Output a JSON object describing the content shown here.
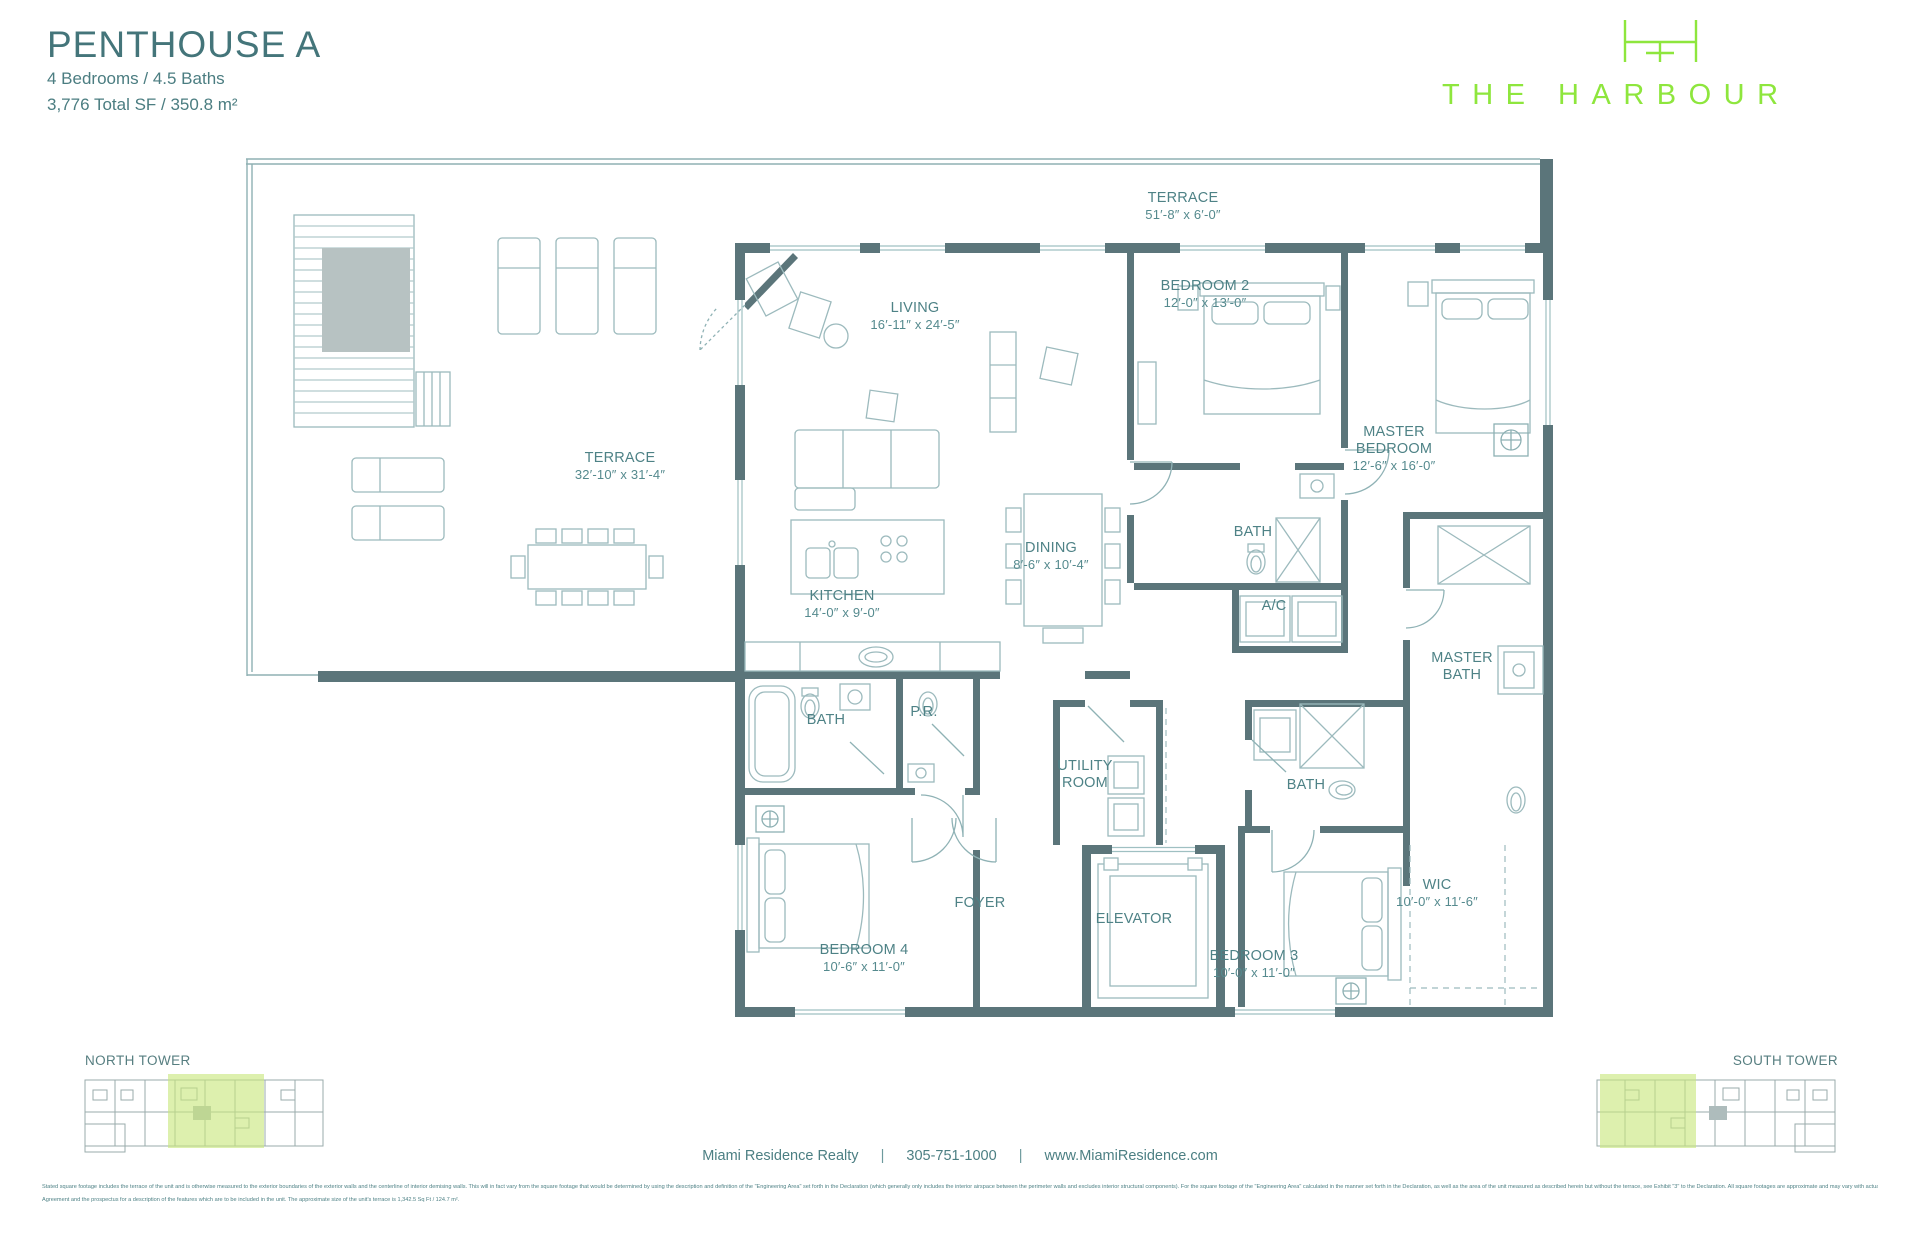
{
  "header": {
    "title": "PENTHOUSE A",
    "specs": "4 Bedrooms / 4.5 Baths",
    "area": "3,776 Total SF / 350.8 m²"
  },
  "brand": {
    "name": "THE HARBOUR"
  },
  "floorplan": {
    "rooms": [
      {
        "id": "terrace-top",
        "label": "TERRACE",
        "dims": "51′-8″ x 6′-0″"
      },
      {
        "id": "living",
        "label": "LIVING",
        "dims": "16′-11″ x 24′-5″"
      },
      {
        "id": "bedroom-2",
        "label": "BEDROOM 2",
        "dims": "12′-0″ x 13′-0″"
      },
      {
        "id": "master-bedroom",
        "label": "MASTER BEDROOM",
        "dims": "12′-6″ x 16′-0″"
      },
      {
        "id": "terrace-left",
        "label": "TERRACE",
        "dims": "32′-10″ x 31′-4″"
      },
      {
        "id": "dining",
        "label": "DINING",
        "dims": "8′-6″ x 10′-4″"
      },
      {
        "id": "kitchen",
        "label": "KITCHEN",
        "dims": "14′-0″ x 9′-0″"
      },
      {
        "id": "bath-2",
        "label": "BATH",
        "dims": ""
      },
      {
        "id": "ac",
        "label": "A/C",
        "dims": ""
      },
      {
        "id": "master-bath",
        "label": "MASTER BATH",
        "dims": ""
      },
      {
        "id": "bath-4",
        "label": "BATH",
        "dims": ""
      },
      {
        "id": "powder-room",
        "label": "P.R.",
        "dims": ""
      },
      {
        "id": "utility-room",
        "label": "UTILITY ROOM",
        "dims": ""
      },
      {
        "id": "bath-3",
        "label": "BATH",
        "dims": ""
      },
      {
        "id": "foyer",
        "label": "FOYER",
        "dims": ""
      },
      {
        "id": "elevator",
        "label": "ELEVATOR",
        "dims": ""
      },
      {
        "id": "wic",
        "label": "WIC",
        "dims": "10′-0″ x 11′-6″"
      },
      {
        "id": "bedroom-4",
        "label": "BEDROOM 4",
        "dims": "10′-6″ x 11′-0″"
      },
      {
        "id": "bedroom-3",
        "label": "BEDROOM 3",
        "dims": "10′-0″ x 11′-0″"
      }
    ]
  },
  "keyplans": {
    "north": "NORTH TOWER",
    "south": "SOUTH TOWER"
  },
  "footer": {
    "realty": "Miami Residence Realty",
    "phone": "305-751-1000",
    "website": "www.MiamiResidence.com",
    "separator": "|",
    "disclaimer1": "Stated square footage includes the terrace of the unit and is otherwise measured to the exterior boundaries of the exterior walls and the centerline of interior demising walls. This will in fact vary from the square footage that would be determined by using the description and definition of the \"Engineering Area\" set forth in the Declaration (which generally only includes the interior airspace between the perimeter walls and excludes interior structural components). For the square footage of the \"Engineering Area\" calculated in the manner set forth in the Declaration, as well as the area of the unit measured as described herein but without the terrace, see Exhibit \"3\" to the Declaration. All square footages are approximate and may vary with actual construction. All floor plans and development plans are subject to change. Plans are not to scale and may be the reverse (mirror) image of those shown. The survey of the units and the provisions of the Declaration of Condominium shall control in determining the boundaries and actual dimensions of the units. All fixtures, furniture, items of finish, and decorations are for display purposes only and will not be included with the unit. Consult the Purchase",
    "disclaimer2": "Agreement and the prospectus for a description of the features which are to be included in the unit. The approximate size of the unit's terrace is 1,342.5 Sq Ft / 124.7 m²."
  }
}
